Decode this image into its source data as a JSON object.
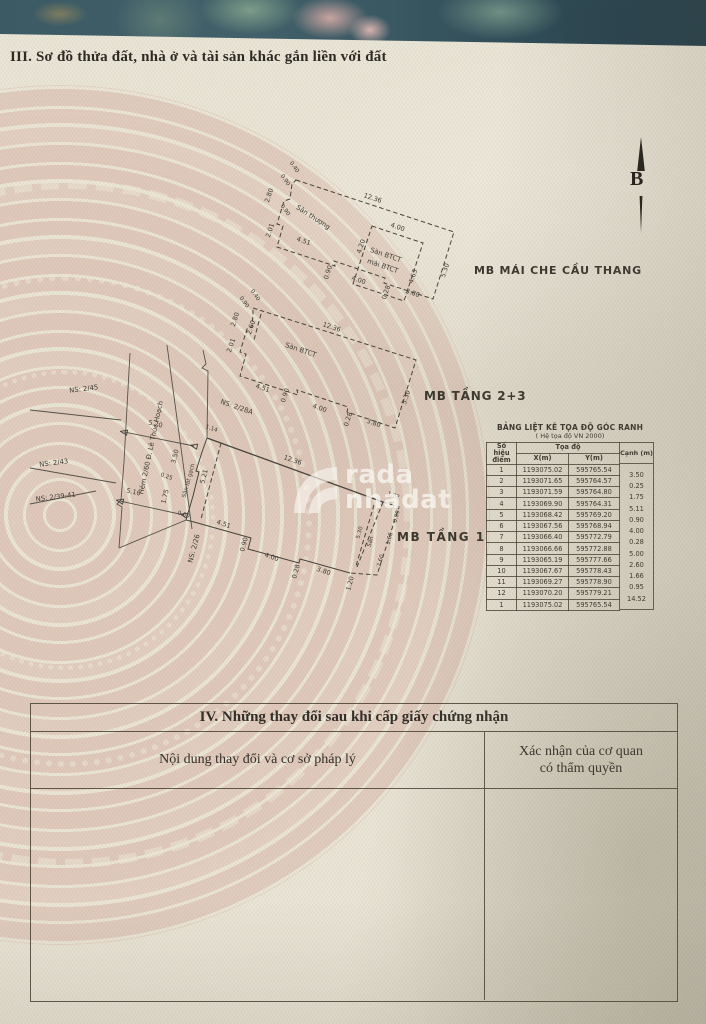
{
  "page": {
    "section3_title": "III. Sơ đồ thửa đất, nhà ở và tài sản khác gắn liền với đất",
    "north_label": "B"
  },
  "watermark": {
    "brand_top": "rada",
    "brand_bottom": "nhadat"
  },
  "plan_roof": {
    "caption": "MB MÁI CHE CẦU THANG",
    "labels": {
      "terrace": "Sân thượng",
      "slab1": "Sàn BTCT",
      "slab2": "mái BTCT"
    },
    "dims": {
      "notch_a": "0.40",
      "notch_b": "0.90",
      "left_upper": "2.80",
      "left_step": "0.90",
      "left_lower": "2.01",
      "top": "12.36",
      "inner_top": "4.00",
      "inner_left": "4.20",
      "inner_right": "4.63",
      "right": "5.30",
      "bottom_left": "4.51",
      "bottom_step": "0.90",
      "inner_bottom": "4.00",
      "bottom_jog": "0.28",
      "bottom_right": "3.80"
    }
  },
  "plan_f23": {
    "caption": "MB TẦNG 2+3",
    "labels": {
      "slab": "Sàn BTCT"
    },
    "dims": {
      "notch_a": "0.40",
      "notch_b": "0.90",
      "left_upper": "2.80",
      "left_inner": "2.60",
      "left_lower": "2.01",
      "top": "12.36",
      "right": "5.30",
      "bottom_left": "4.51",
      "bottom_step": "0.90",
      "bottom_mid": "4.00",
      "bottom_jog": "0.28",
      "bottom_right": "3.80"
    }
  },
  "plan_f1": {
    "caption": "MB TẦNG 1",
    "labels": {
      "tiled_yard": "Sân lát gạch",
      "yard": "Sân",
      "alley": "Hẻm 2/60 Đ. Lê Thúc Hoạch",
      "ns45": "NS: 2/45",
      "ns43": "NS: 2/43",
      "ns3941": "NS: 2/39-41",
      "ns26": "NS: 2/26",
      "ns28a": "NS: 2/28A"
    },
    "dims": {
      "top": "12.36",
      "gate": "1.14",
      "street": "5.20",
      "front_a": "3.50",
      "front_b": "0.25",
      "front_c": "1.75",
      "inner_v": "5.21",
      "street_b": "5.10",
      "bottom_a": "0.60",
      "bottom_b": "4.51",
      "bottom_step": "0.90",
      "bottom_c": "4.00",
      "bottom_jog": "0.28",
      "bottom_d": "3.80",
      "bottom_e": "1.20",
      "yard_top": "1.02",
      "yard_a": "0.99",
      "yard_b": "1.66",
      "yard_c": "2.60",
      "yard_v": "5.30"
    }
  },
  "coord_table": {
    "title": "BẢNG LIỆT KÊ TỌA ĐỘ GÓC RANH",
    "subtitle": "( Hệ tọa độ VN 2000)",
    "col_point_1": "Số hiệu",
    "col_point_2": "điểm",
    "col_coord": "Tọa độ",
    "col_x": "X(m)",
    "col_y": "Y(m)",
    "col_edge": "Cạnh (m)",
    "rows": [
      {
        "p": "1",
        "x": "1193075.02",
        "y": "595765.54"
      },
      {
        "p": "2",
        "x": "1193071.65",
        "y": "595764.57"
      },
      {
        "p": "3",
        "x": "1193071.59",
        "y": "595764.80"
      },
      {
        "p": "4",
        "x": "1193069.90",
        "y": "595764.31"
      },
      {
        "p": "5",
        "x": "1193068.42",
        "y": "595769.20"
      },
      {
        "p": "6",
        "x": "1193067.56",
        "y": "595768.94"
      },
      {
        "p": "7",
        "x": "1193066.40",
        "y": "595772.79"
      },
      {
        "p": "8",
        "x": "1193066.66",
        "y": "595772.88"
      },
      {
        "p": "9",
        "x": "1193065.19",
        "y": "595777.66"
      },
      {
        "p": "10",
        "x": "1193067.67",
        "y": "595778.43"
      },
      {
        "p": "11",
        "x": "1193069.27",
        "y": "595778.90"
      },
      {
        "p": "12",
        "x": "1193070.20",
        "y": "595779.21"
      },
      {
        "p": "1",
        "x": "1193075.02",
        "y": "595765.54"
      }
    ],
    "edges": [
      "3.50",
      "0.25",
      "1.75",
      "5.11",
      "0.90",
      "4.00",
      "0.28",
      "5.00",
      "2.60",
      "1.66",
      "0.95",
      "14.52"
    ]
  },
  "section4": {
    "title": "IV. Những thay đổi sau khi cấp giấy chứng nhận",
    "col_content": "Nội dung thay đổi và cơ sở pháp lý",
    "col_confirm_1": "Xác nhận của cơ quan",
    "col_confirm_2": "có thẩm quyền"
  }
}
